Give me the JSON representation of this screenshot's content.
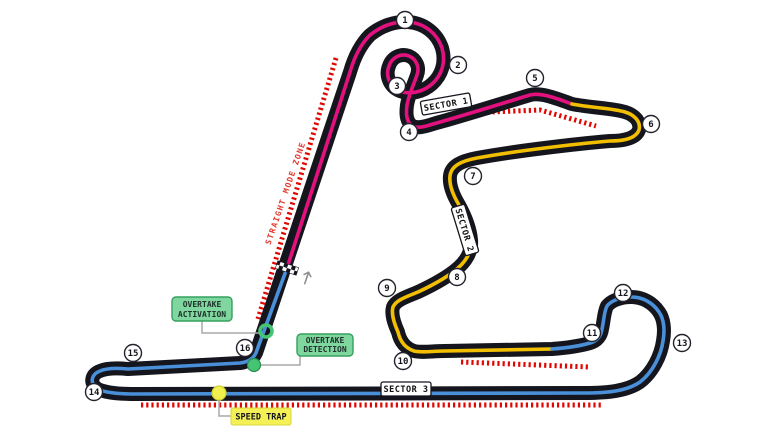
{
  "diagram": {
    "type": "racing-circuit-map",
    "direction": "clockwise"
  },
  "corners": [
    "1",
    "2",
    "3",
    "4",
    "5",
    "6",
    "7",
    "8",
    "9",
    "10",
    "11",
    "12",
    "13",
    "14",
    "15",
    "16"
  ],
  "sectors": [
    {
      "label": "SECTOR 1",
      "color": "#E3117E"
    },
    {
      "label": "SECTOR 2",
      "color": "#F2BE00"
    },
    {
      "label": "SECTOR 3",
      "color": "#4A90D8"
    }
  ],
  "legend": {
    "straight_mode_zone": "STRAIGHT MODE ZONE",
    "overtake_activation": {
      "line1": "OVERTAKE",
      "line2": "ACTIVATION"
    },
    "overtake_detection": {
      "line1": "OVERTAKE",
      "line2": "DETECTION"
    },
    "speed_trap": "SPEED TRAP"
  },
  "colors": {
    "track": "#15151E",
    "sector1_line": "#E3117E",
    "sector2_line": "#F2BE00",
    "sector3_line": "#4A90D8",
    "trackside_red": "#E10600",
    "zone_text_red": "#E0392E",
    "marker_green": "#45C473",
    "marker_yellow": "#F2F04E",
    "callout_green_bg": "#7FD69E",
    "callout_yellow_bg": "#F3F155",
    "background": "#ffffff"
  }
}
